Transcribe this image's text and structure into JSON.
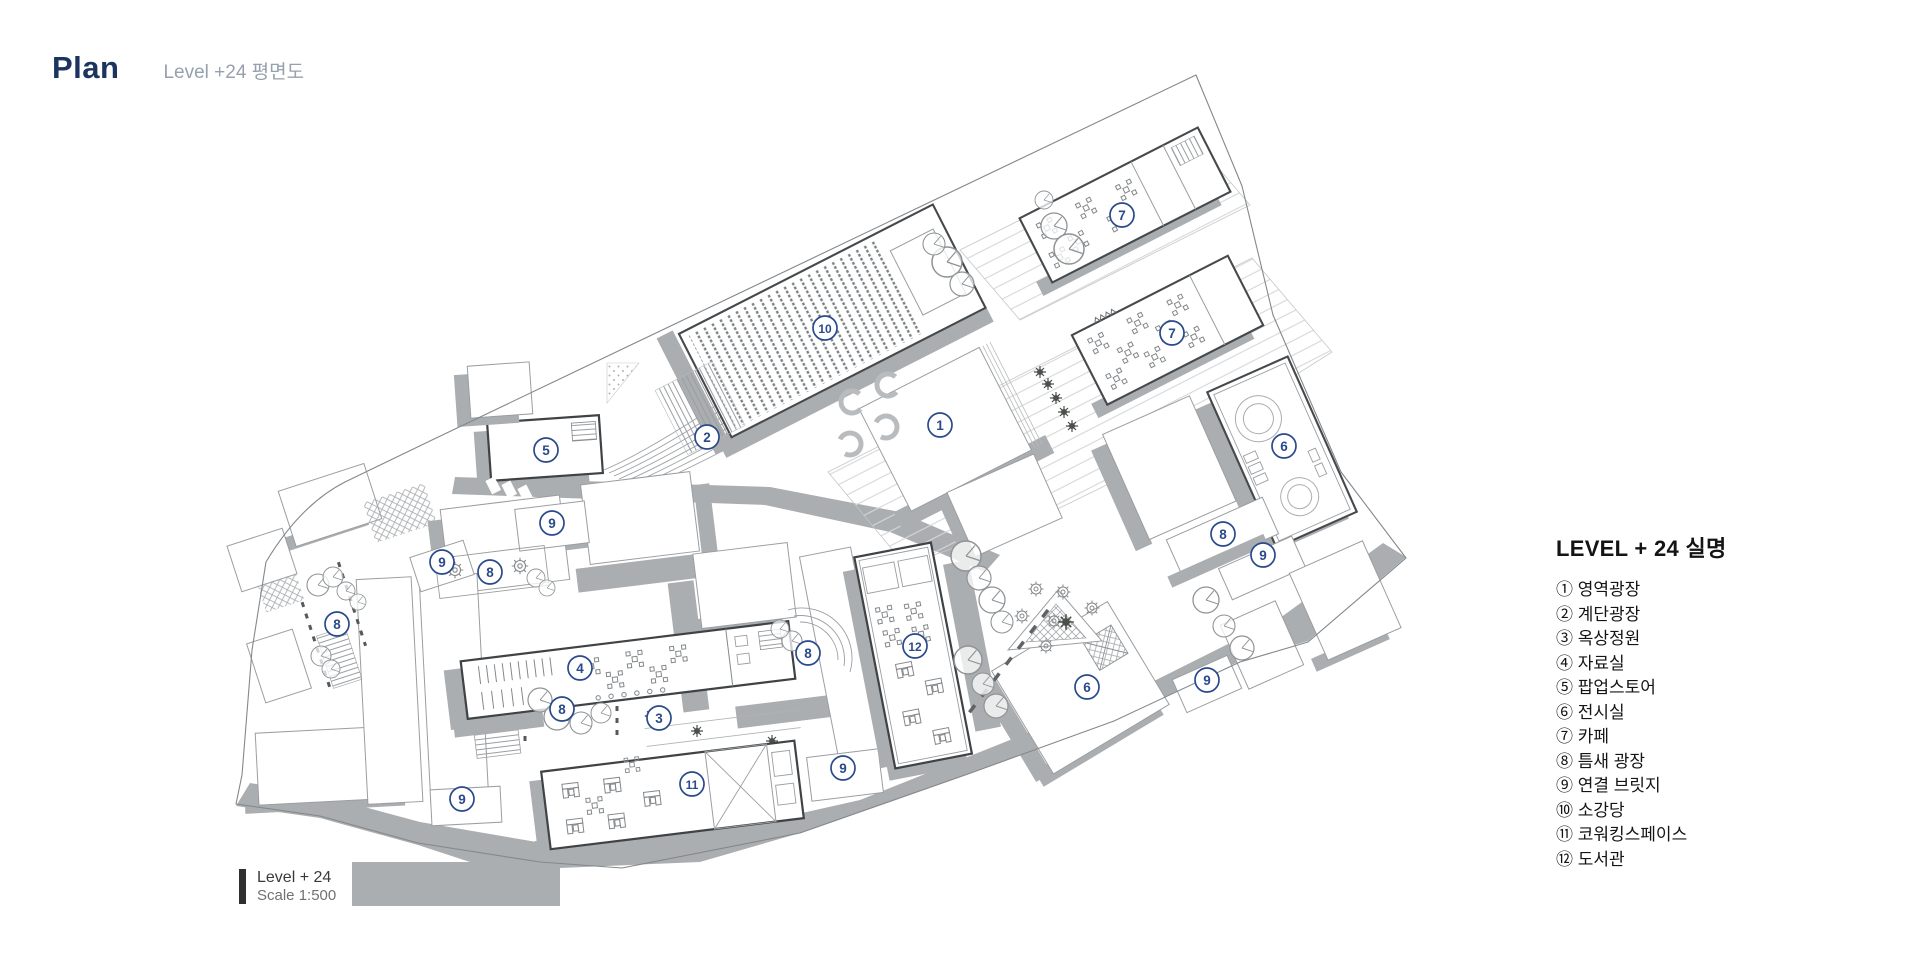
{
  "header": {
    "title": "Plan",
    "subtitle": "Level +24 평면도"
  },
  "legend": {
    "title": "LEVEL + 24  실명",
    "items": [
      {
        "num": "①",
        "label": "영역광장"
      },
      {
        "num": "②",
        "label": "계단광장"
      },
      {
        "num": "③",
        "label": "옥상정원"
      },
      {
        "num": "④",
        "label": "자료실"
      },
      {
        "num": "⑤",
        "label": "팝업스토어"
      },
      {
        "num": "⑥",
        "label": "전시실"
      },
      {
        "num": "⑦",
        "label": "카페"
      },
      {
        "num": "⑧",
        "label": "틈새 광장"
      },
      {
        "num": "⑨",
        "label": "연결 브릿지"
      },
      {
        "num": "⑩",
        "label": "소강당"
      },
      {
        "num": "⑪",
        "label": "코워킹스페이스"
      },
      {
        "num": "⑫",
        "label": "도서관"
      }
    ]
  },
  "scale_block": {
    "level": "Level + 24",
    "scale": "Scale 1:500"
  },
  "plan": {
    "marker_color": "#2a4a8c",
    "title_color": "#1b355f",
    "shadow_color": "#abaeb1",
    "markers": [
      {
        "n": "1",
        "x": 940,
        "y": 425
      },
      {
        "n": "2",
        "x": 707,
        "y": 437
      },
      {
        "n": "3",
        "x": 659,
        "y": 718
      },
      {
        "n": "4",
        "x": 580,
        "y": 668
      },
      {
        "n": "5",
        "x": 546,
        "y": 450
      },
      {
        "n": "6",
        "x": 1284,
        "y": 446
      },
      {
        "n": "6",
        "x": 1087,
        "y": 687
      },
      {
        "n": "7",
        "x": 1122,
        "y": 215
      },
      {
        "n": "7",
        "x": 1172,
        "y": 333
      },
      {
        "n": "8",
        "x": 1223,
        "y": 534
      },
      {
        "n": "8",
        "x": 490,
        "y": 572
      },
      {
        "n": "8",
        "x": 337,
        "y": 624
      },
      {
        "n": "8",
        "x": 808,
        "y": 653
      },
      {
        "n": "8",
        "x": 562,
        "y": 709
      },
      {
        "n": "9",
        "x": 552,
        "y": 523
      },
      {
        "n": "9",
        "x": 442,
        "y": 562
      },
      {
        "n": "9",
        "x": 1263,
        "y": 555
      },
      {
        "n": "9",
        "x": 1207,
        "y": 680
      },
      {
        "n": "9",
        "x": 843,
        "y": 768
      },
      {
        "n": "9",
        "x": 462,
        "y": 799
      },
      {
        "n": "10",
        "x": 825,
        "y": 328
      },
      {
        "n": "11",
        "x": 692,
        "y": 784
      },
      {
        "n": "12",
        "x": 915,
        "y": 646
      }
    ]
  }
}
